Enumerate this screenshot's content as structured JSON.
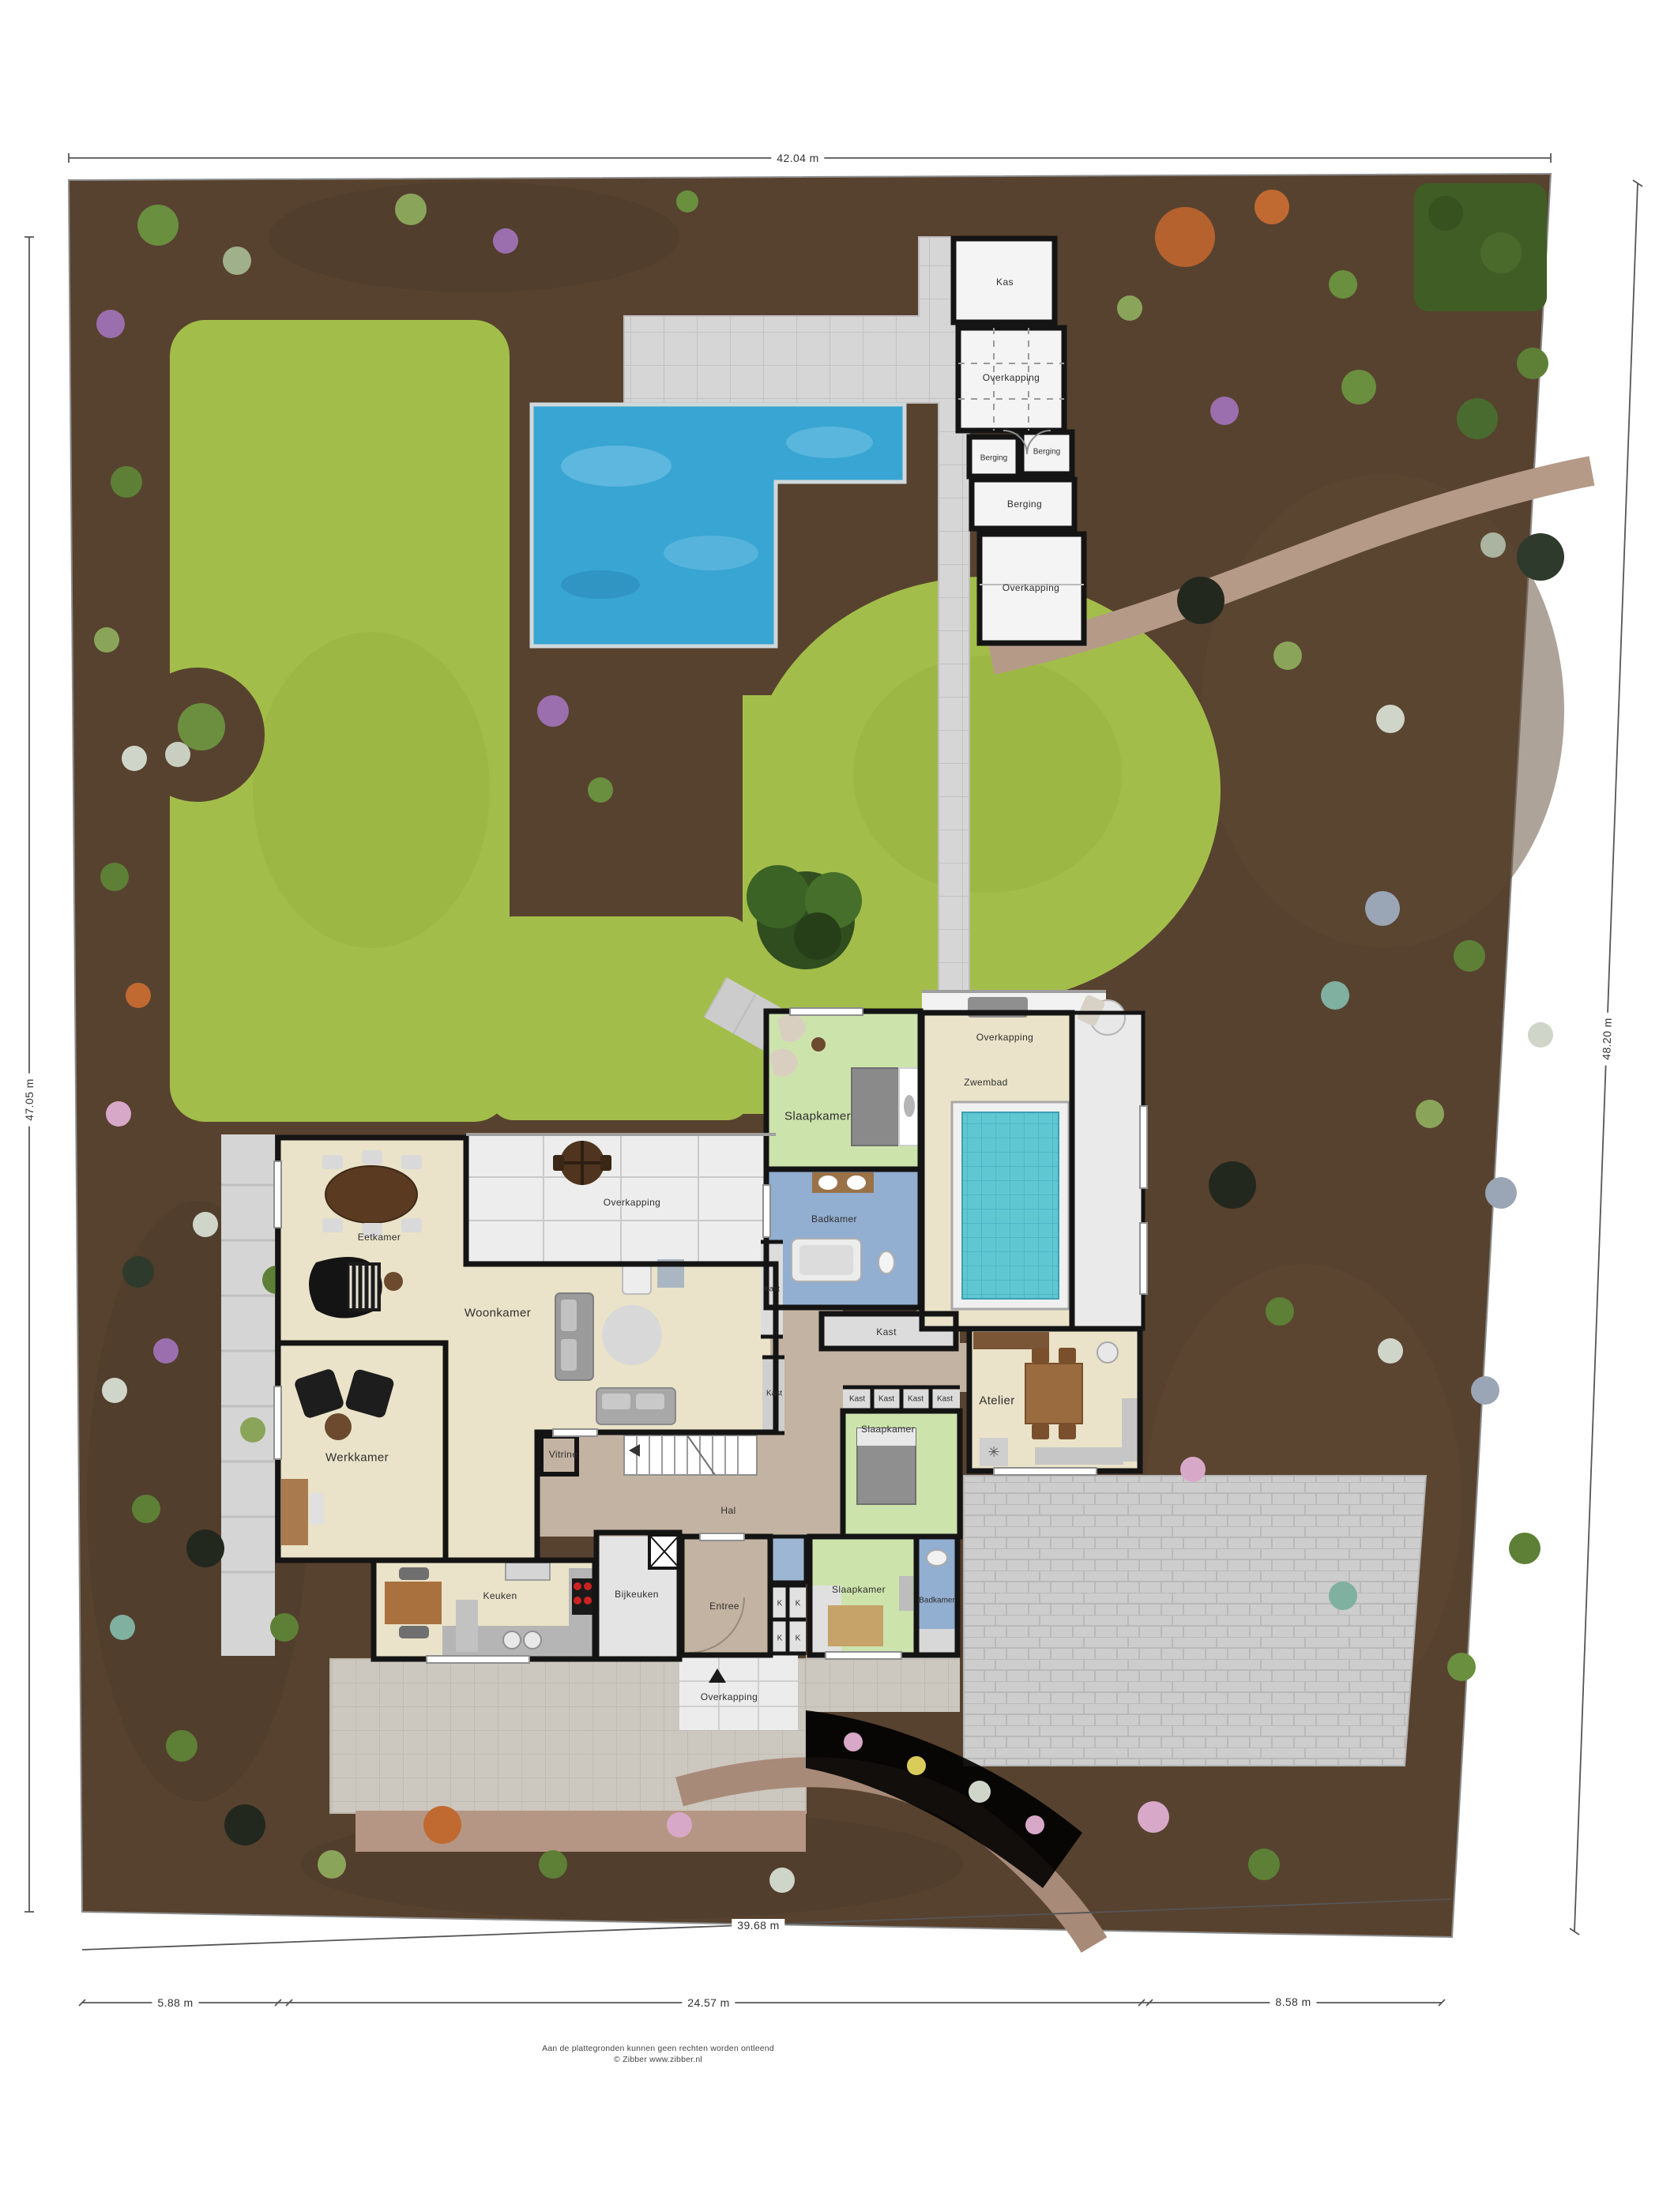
{
  "site": {
    "dimensions": {
      "top": "42.04 m",
      "left": "47.05 m",
      "right": "48.20 m",
      "bottom_total": "39.68 m",
      "bottom_segments": [
        "5.88 m",
        "24.57 m",
        "8.58 m"
      ]
    },
    "outbuildings": {
      "kas": "Kas",
      "overkapping_top": "Overkapping",
      "berging_1": "Berging",
      "berging_2": "Berging",
      "berging_3": "Berging",
      "overkapping_mid": "Overkapping"
    },
    "rooms": {
      "slaapkamer_top": "Slaapkamer",
      "overkapping_pool": "Overkapping",
      "zwembad": "Zwembad",
      "badkamer_top": "Badkamer",
      "kast_v1": "Kast",
      "kast_wide": "Kast",
      "kast_v2": "Kast",
      "eetkamer": "Eetkamer",
      "overkapping_terras": "Overkapping",
      "woonkamer": "Woonkamer",
      "werkkamer": "Werkkamer",
      "vitrine": "Vitrine",
      "hal": "Hal",
      "keuken": "Keuken",
      "bijkeuken": "Bijkeuken",
      "entree": "Entree",
      "kast_row": [
        "Kast",
        "Kast",
        "Kast",
        "Kast"
      ],
      "k_labels": [
        "K",
        "K",
        "K",
        "K"
      ],
      "slaapkamer_mid": "Slaapkamer",
      "atelier": "Atelier",
      "slaapkamer_bottom": "Slaapkamer",
      "badkamer_bottom": "Badkamer",
      "overkapping_porch": "Overkapping"
    },
    "footer": {
      "line1": "Aan de plattegronden kunnen geen rechten worden ontleend",
      "line2": "© Zibber www.zibber.nl"
    },
    "colors": {
      "soil": "#57422f",
      "lawn": "#a3bd4a",
      "pool_outdoor": "#38a5d2",
      "pool_indoor": "#5ec7d2",
      "room_beige": "#eae3c9",
      "room_green": "#cde3ac",
      "room_blue": "#92aed0",
      "hall_tan": "#c3b3a2",
      "paving": "#d6d6d6",
      "wall": "#141414"
    }
  }
}
